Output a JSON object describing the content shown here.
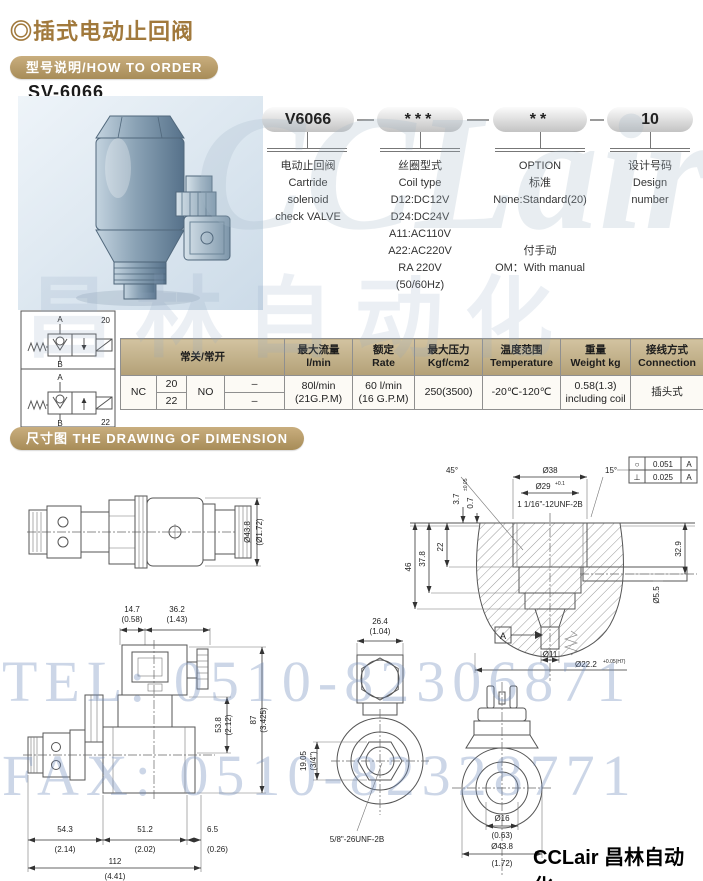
{
  "page": {
    "title": "◎插式电动止回阀",
    "section_how_to_order": "型号说明/HOW TO ORDER",
    "model": "SV-6066",
    "section_dimension": "尺寸图  THE DRAWING OF DIMENSION",
    "brand_footer": "CCLair 昌林自动化",
    "watermark_tel": "TEL: 0510-82306871",
    "watermark_fax": "FAX: 0510-82328771",
    "watermark_brand": "CCLair",
    "watermark_cn": "昌林自动化"
  },
  "order_code": {
    "segments": [
      {
        "code": "V6066",
        "desc": [
          "电动止回阀",
          "Cartride",
          "solenoid",
          "check VALVE"
        ]
      },
      {
        "code": "***",
        "desc": [
          "丝圈型式",
          "Coil type",
          "D12:DC12V",
          "D24:DC24V",
          "A11:AC110V",
          "A22:AC220V",
          "RA 220V",
          "(50/60Hz)"
        ]
      },
      {
        "code": "**",
        "desc": [
          "OPTION",
          "标准",
          "None:Standard(20)",
          "",
          "",
          "付手动",
          "OM：With manual"
        ]
      },
      {
        "code": "10",
        "desc": [
          "设计号码",
          "Design",
          "number"
        ]
      }
    ]
  },
  "schematic": {
    "label_top": "20",
    "label_bottom": "22",
    "port_a": "A",
    "port_b": "B"
  },
  "spec_table": {
    "col_nc_no": "常关/常开",
    "col_flow": [
      "最大流量",
      "l/min"
    ],
    "col_rate": [
      "额定",
      "Rate"
    ],
    "col_pressure": [
      "最大压力",
      "Kgf/cm2"
    ],
    "col_temp": [
      "温度范围",
      "Temperature"
    ],
    "col_weight": [
      "重量",
      "Weight kg"
    ],
    "col_connection": [
      "接线方式",
      "Connection"
    ],
    "nc": "NC",
    "nc_top": "20",
    "nc_bottom": "22",
    "no": "NO",
    "no_top": "–",
    "no_bottom": "–",
    "flow": [
      "80l/min",
      "(21G.P.M)"
    ],
    "rate": [
      "60 l/min",
      "(16 G.P.M)"
    ],
    "pressure": "250(3500)",
    "temp": "-20℃-120℃",
    "weight": [
      "0.58(1.3)",
      "including coil"
    ],
    "connection": "插头式"
  },
  "dims": {
    "profile": {
      "dia": "Ø43.8",
      "dia_in": "(Ø1.72)"
    },
    "cavity": {
      "angle1": "45°",
      "dia38": "Ø38",
      "angle2": "15°",
      "dia29": "Ø29",
      "dia29_tol": "+0.1",
      "thread": "1 1/16\"-12UNF-2B",
      "d37": "3.7",
      "d07": "0.7",
      "d07_tol": "±0.05",
      "d22": "22",
      "d378": "37.8",
      "d46": "46",
      "d329": "32.9",
      "dia55": "Ø5.5",
      "dia11": "Ø11",
      "dia222": "Ø22.2",
      "dia222_tol": "+0.05(H7)",
      "fcf_row1": {
        "sym": "○",
        "tol": "0.051",
        "datum": "A"
      },
      "fcf_row2": {
        "sym": "⊥",
        "tol": "0.025",
        "datum": "A"
      },
      "datum": "A"
    },
    "side": {
      "d147": "14.7",
      "d147_in": "(0.58)",
      "d362": "36.2",
      "d362_in": "(1.43)",
      "d538": "53.8",
      "d538_in": "(2.12)",
      "d87": "87",
      "d87_in": "(3.425)",
      "d543": "54.3",
      "d543_in": "(2.14)",
      "d512": "51.2",
      "d512_in": "(2.02)",
      "d65": "6.5",
      "d65_in": "(0.26)",
      "d112": "112",
      "d112_in": "(4.41)"
    },
    "end": {
      "d264": "26.4",
      "d264_in": "(1.04)",
      "d1905": "19.05",
      "d1905_in": "(3/4\")",
      "thread": "5/8\"-26UNF-2B"
    },
    "coil": {
      "dia16": "Ø16",
      "dia16_in": "(0.63)",
      "dia438": "Ø43.8",
      "dia438_in": "(1.72)"
    }
  }
}
